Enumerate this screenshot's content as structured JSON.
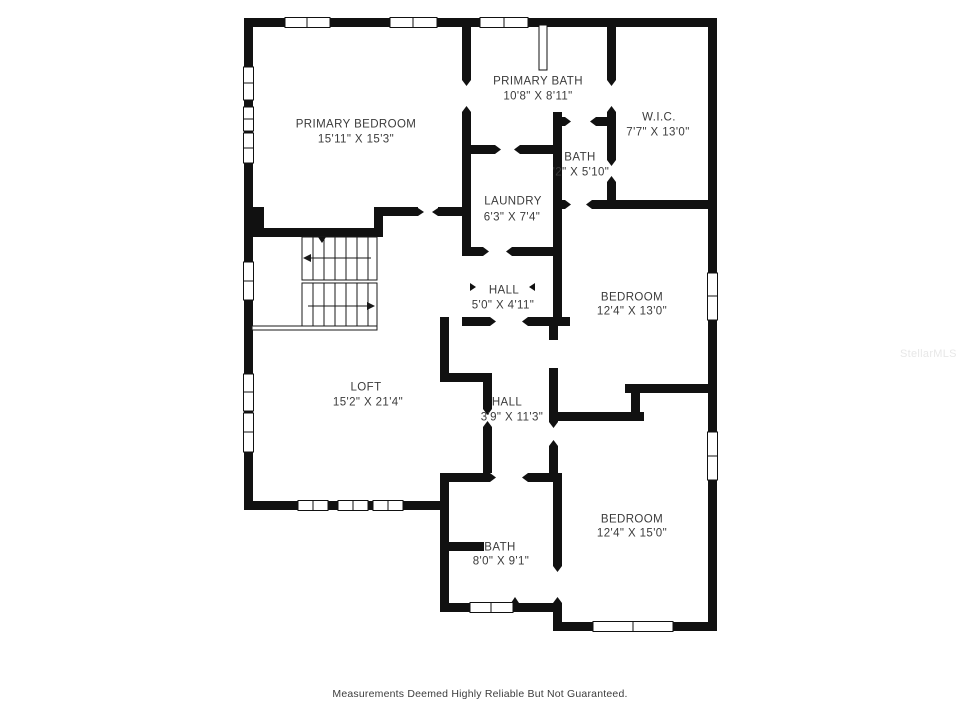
{
  "plan": {
    "wall_color": "#111111",
    "rooms": {
      "primary_bedroom": {
        "name": "PRIMARY BEDROOM",
        "dims": "15'11\" X 15'3\""
      },
      "primary_bath": {
        "name": "PRIMARY BATH",
        "dims": "10'8\" X 8'11\""
      },
      "wic": {
        "name": "W.I.C.",
        "dims": "7'7\" X 13'0\""
      },
      "bath_upper": {
        "name": "BATH",
        "dims": "'2\" X 5'10\""
      },
      "laundry": {
        "name": "LAUNDRY",
        "dims": "6'3\" X 7'4\""
      },
      "hall_upper": {
        "name": "HALL",
        "dims": "5'0\" X 4'11\""
      },
      "bedroom_east": {
        "name": "BEDROOM",
        "dims": "12'4\" X 13'0\""
      },
      "loft": {
        "name": "LOFT",
        "dims": "15'2\" X 21'4\""
      },
      "hall_lower": {
        "name": "HALL",
        "dims": "3'9\" X 11'3\""
      },
      "bedroom_southeast": {
        "name": "BEDROOM",
        "dims": "12'4\" X 15'0\""
      },
      "bath_lower": {
        "name": "BATH",
        "dims": "8'0\" X 9'1\""
      }
    }
  },
  "footer": {
    "disclaimer": "Measurements Deemed Highly Reliable But Not Guaranteed."
  },
  "watermark": "StellarMLS"
}
